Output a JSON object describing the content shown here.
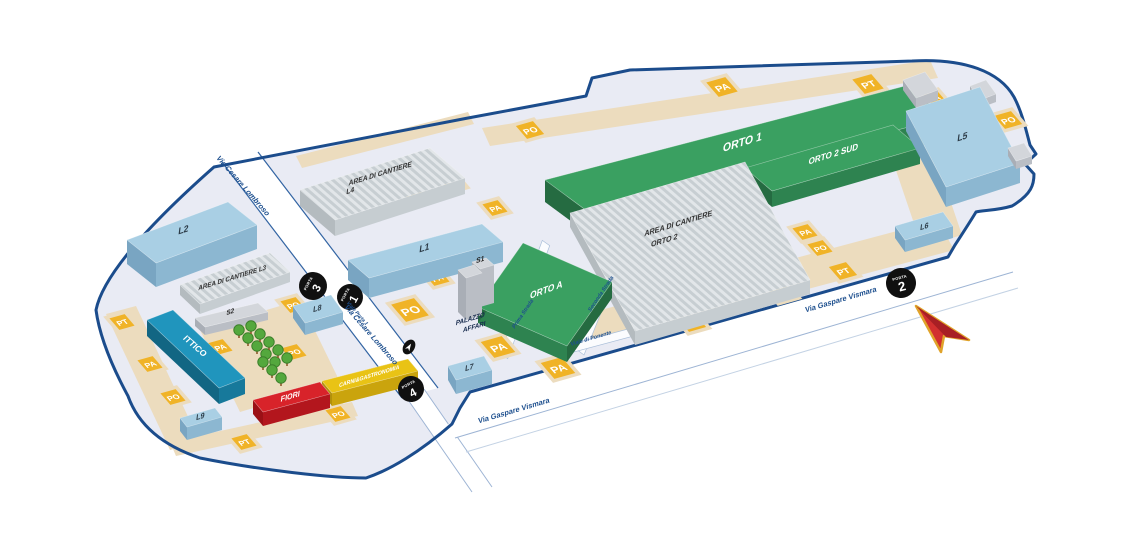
{
  "map": {
    "markers": {
      "pa": "PA",
      "po": "PO",
      "pt": "PT"
    },
    "gates": {
      "label": "PORTA",
      "numbers": {
        "n1": "1",
        "n2": "2",
        "n3": "3",
        "n4": "4"
      }
    },
    "streets": {
      "lombroso": "Via Cesare Lombroso",
      "vismara": "Via Gaspare Vismara",
      "viale_porta1": "Viale Porta 1",
      "prima": "Prima Strada",
      "seconda": "Seconda Strada",
      "ponente": "Viale di Ponente"
    },
    "buildings": {
      "orto1": "ORTO 1",
      "orto2sud": "ORTO 2 SUD",
      "ortoa": "ORTO A",
      "area_cantiere": "AREA DI CANTIERE",
      "area_l3": "AREA DI CANTIERE L3",
      "orto2": "ORTO 2",
      "l1": "L1",
      "l2": "L2",
      "l4": "L4",
      "l5": "L5",
      "l6": "L6",
      "l7": "L7",
      "l8": "L8",
      "l9": "L9",
      "s1": "S1",
      "s2": "S2",
      "ittico": "ITTICO",
      "fiori": "FIORI",
      "carni": "CARNI&GASTRONOMIA",
      "palazzo1": "PALAZZO",
      "palazzo2": "AFFARI"
    },
    "colors": {
      "boundary": "#1b4c8c",
      "interior": "#e9ebf4",
      "tan": "#ecdcbe",
      "marker": "#f0b327",
      "street_text": "#1d4f8e",
      "green_top": "#3aa061",
      "green_front": "#2e8350",
      "green_side": "#256b41",
      "blue_top": "#a9cfe4",
      "blue_front": "#8cb7d1",
      "blue_side": "#79a5c2",
      "teal_top": "#2095bd",
      "teal_front": "#17799b",
      "teal_side": "#126683",
      "red_top": "#d8232a",
      "red_front": "#b3161d",
      "red_side": "#9b1016",
      "yellow_top": "#e9c315",
      "yellow_front": "#caa40d",
      "yellow_side": "#b2900b",
      "gray_top": "#d3d6db",
      "gray_front": "#babec5",
      "gray_side": "#a9aeb6",
      "stripe_light": "#e2e6e9",
      "stripe_dark": "#c7ced2",
      "road_edge": "#3264a3",
      "road_edge_light": "#9db4d4",
      "gate_bg": "#101010",
      "arrow_fill": "#d2302f",
      "arrow_dark": "#a81f24",
      "arrow_stroke": "#e0a32a",
      "tree": "#54a83d",
      "tree_dark": "#3c7f2b",
      "label_dark": "#2b3a46"
    }
  }
}
